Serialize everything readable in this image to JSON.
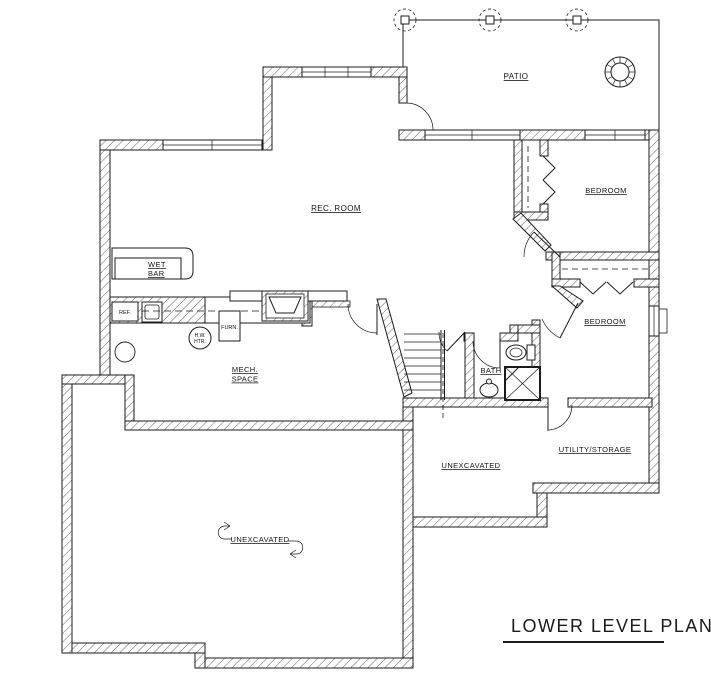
{
  "title": "LOWER LEVEL PLAN",
  "rooms": {
    "patio": "PATIO",
    "rec_room": "REC. ROOM",
    "bedroom_1": "BEDROOM",
    "bedroom_2": "BEDROOM",
    "bath": "BATH",
    "utility_storage": "UTILITY/STORAGE",
    "mech_space": {
      "line1": "MECH.",
      "line2": "SPACE"
    },
    "unexcavated_lower": "UNEXCAVATED",
    "unexcavated_mid": "UNEXCAVATED"
  },
  "fixtures": {
    "wet_bar": {
      "line1": "WET",
      "line2": "BAR"
    },
    "refrigerator": "REF.",
    "furnace": "FURN.",
    "water_heater": {
      "line1": "H.W.",
      "line2": "HTR."
    }
  },
  "colors": {
    "ink": "#1b1b1b",
    "paper": "#ffffff",
    "shadow": "#aaaaaa"
  }
}
